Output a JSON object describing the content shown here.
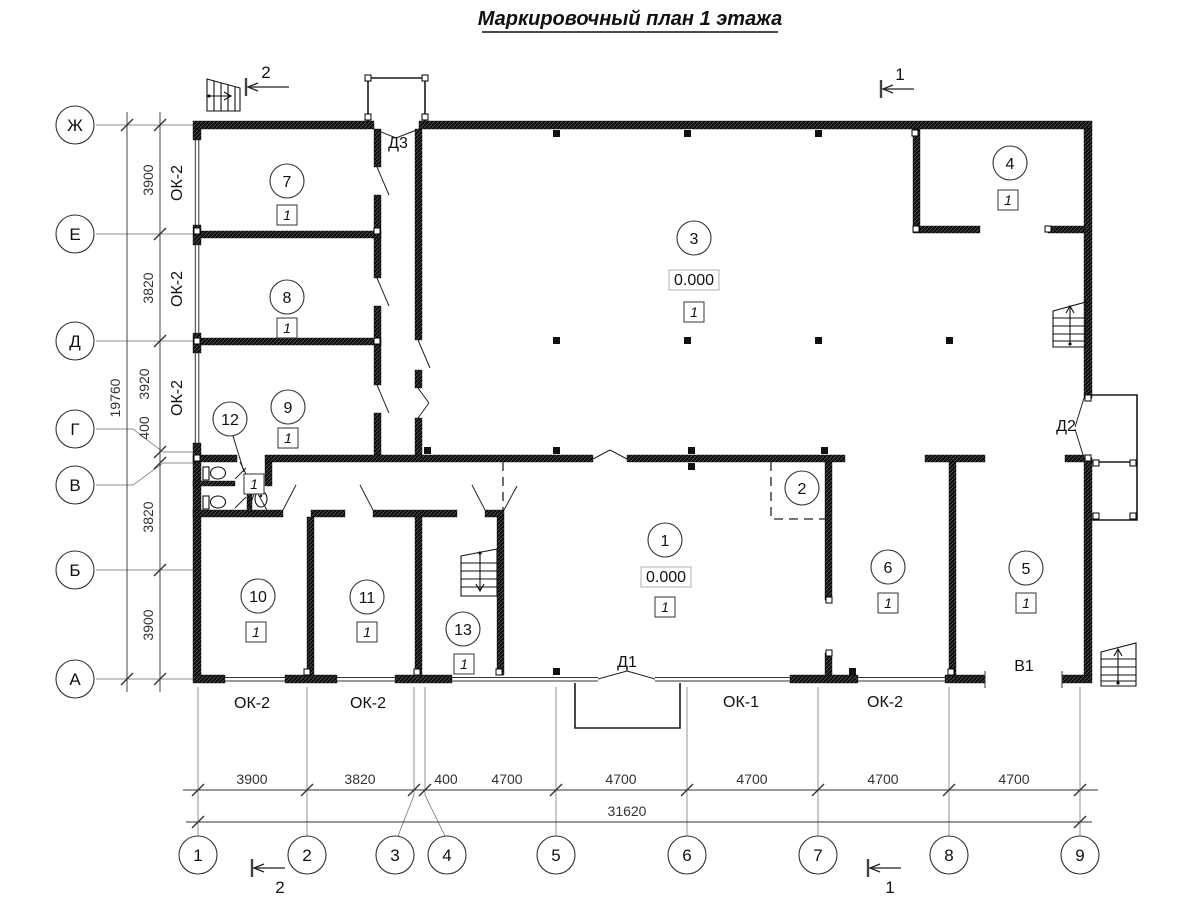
{
  "title": "Маркировочный план 1 этажа",
  "axes": {
    "v": [
      "Ж",
      "Е",
      "Д",
      "Г",
      "В",
      "Б",
      "А"
    ],
    "h": [
      "1",
      "2",
      "3",
      "4",
      "5",
      "6",
      "7",
      "8",
      "9"
    ]
  },
  "dims": {
    "left": [
      "3900",
      "3820",
      "3920",
      "400",
      "3820",
      "3900"
    ],
    "leftTotal": "19760",
    "bottom": [
      "3900",
      "3820",
      "400",
      "4700",
      "4700",
      "4700",
      "4700",
      "4700"
    ],
    "bottomTotal": "31620"
  },
  "rooms": {
    "r1": {
      "num": "1",
      "finish": "1",
      "elevation": "0.000"
    },
    "r2": {
      "num": "2"
    },
    "r3": {
      "num": "3",
      "finish": "1",
      "elevation": "0.000"
    },
    "r4": {
      "num": "4",
      "finish": "1"
    },
    "r5": {
      "num": "5",
      "finish": "1"
    },
    "r6": {
      "num": "6",
      "finish": "1"
    },
    "r7": {
      "num": "7",
      "finish": "1"
    },
    "r8": {
      "num": "8",
      "finish": "1"
    },
    "r9": {
      "num": "9",
      "finish": "1"
    },
    "r10": {
      "num": "10",
      "finish": "1"
    },
    "r11": {
      "num": "11",
      "finish": "1"
    },
    "r12": {
      "num": "12",
      "finish": "1"
    },
    "r13": {
      "num": "13",
      "finish": "1"
    }
  },
  "doors": {
    "d1": "Д1",
    "d2": "Д2",
    "d3": "Д3"
  },
  "gates": {
    "v1": "В1"
  },
  "windows": {
    "ok1": "ОК-1",
    "ok2": "ОК-2"
  },
  "sections": {
    "s1": "1",
    "s2": "2"
  }
}
